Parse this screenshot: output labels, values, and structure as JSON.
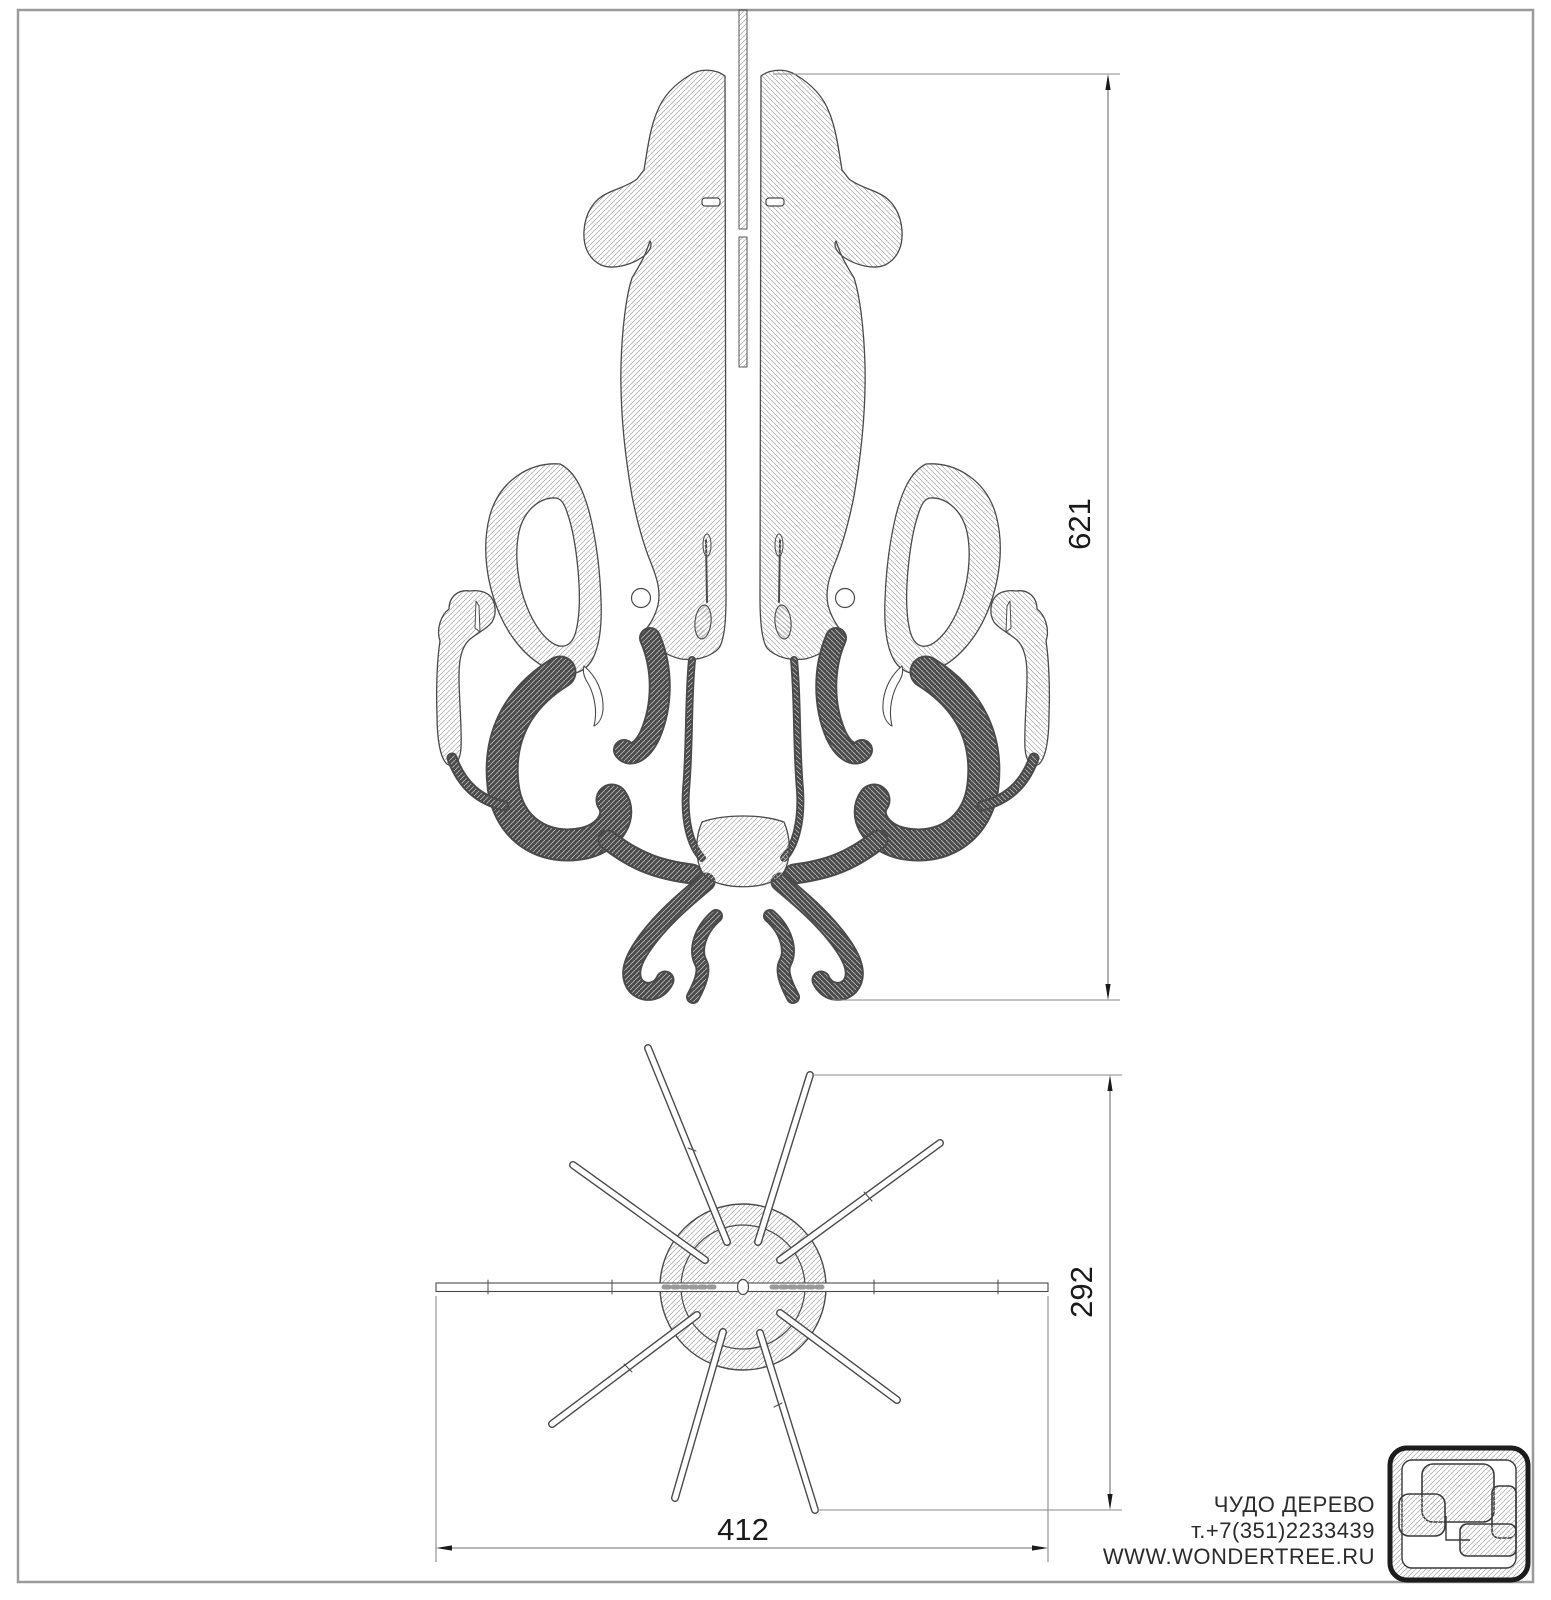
{
  "sheet": {
    "type": "technical-drawing",
    "views": {
      "front": "squid 3d-puzzle front elevation",
      "top": "squid 3d-puzzle plan view"
    }
  },
  "dimensions": {
    "front_height": "621",
    "top_depth": "292",
    "top_width": "412"
  },
  "footer": {
    "company": "ЧУДО ДЕРЕВО",
    "phone": "т.+7(351)2233439",
    "website": "WWW.WONDERTREE.RU"
  },
  "icons": {
    "logo": "wondertree-puzzle-logo"
  },
  "colors": {
    "paper": "#ffffff",
    "frame": "#9a9a9a",
    "outline": "#4a4a4a",
    "hatch": "#b5b5b5",
    "dimension_line": "#8a8a8a",
    "dimension_text": "#1a1a1a"
  }
}
